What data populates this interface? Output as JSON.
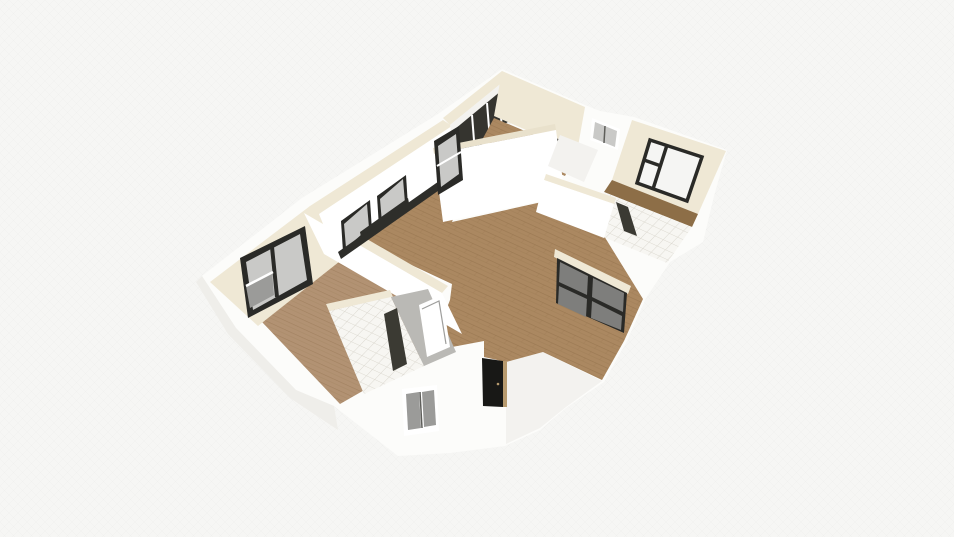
{
  "app": {
    "view_name": "floorplan-3d-viewport",
    "content_type": "3d-floorplan-render"
  },
  "palette": {
    "background": "#f6f6f4",
    "bg_grid": "#ebebe9",
    "wall_white": "#fcfcfa",
    "wall_bright": "#ffffff",
    "wall_shade": "#f3f2ef",
    "wall_shade2": "#efeeea",
    "wall_cream": "#efe8d5",
    "wall_cream_dark": "#e9e1cc",
    "wood": "#ab8861",
    "wood_light": "#b29273",
    "wood_dark": "#8d6e47",
    "wood_line": "#8a6a44",
    "frame_black": "#2a2a27",
    "window_dark": "#35342f",
    "glass_gray": "#c9c9c7",
    "glass_mid": "#9b9b99",
    "glass_dark": "#7e7e7c",
    "glass_white": "#f5f5f3",
    "tile": "#f7f6f2",
    "tile_line": "#d9d5cb",
    "door_black": "#181816",
    "door_slash": "#3b3a33",
    "door_tan": "#b79a6e",
    "floor_gray": "#bab9b5",
    "counter_dark": "#2e2e2a",
    "sash_gray": "#5e5e5a"
  },
  "scene": {
    "rooms": [
      "bedroom-top",
      "bedroom-right",
      "bedroom-left",
      "living-dining",
      "kitchen-wall",
      "bathroom-top-right",
      "bathroom-bottom-left",
      "hallway",
      "entry"
    ],
    "features": [
      "sliding-glass-door",
      "front-door",
      "balcony-deck",
      "tiled-floors",
      "wood-floors"
    ]
  }
}
